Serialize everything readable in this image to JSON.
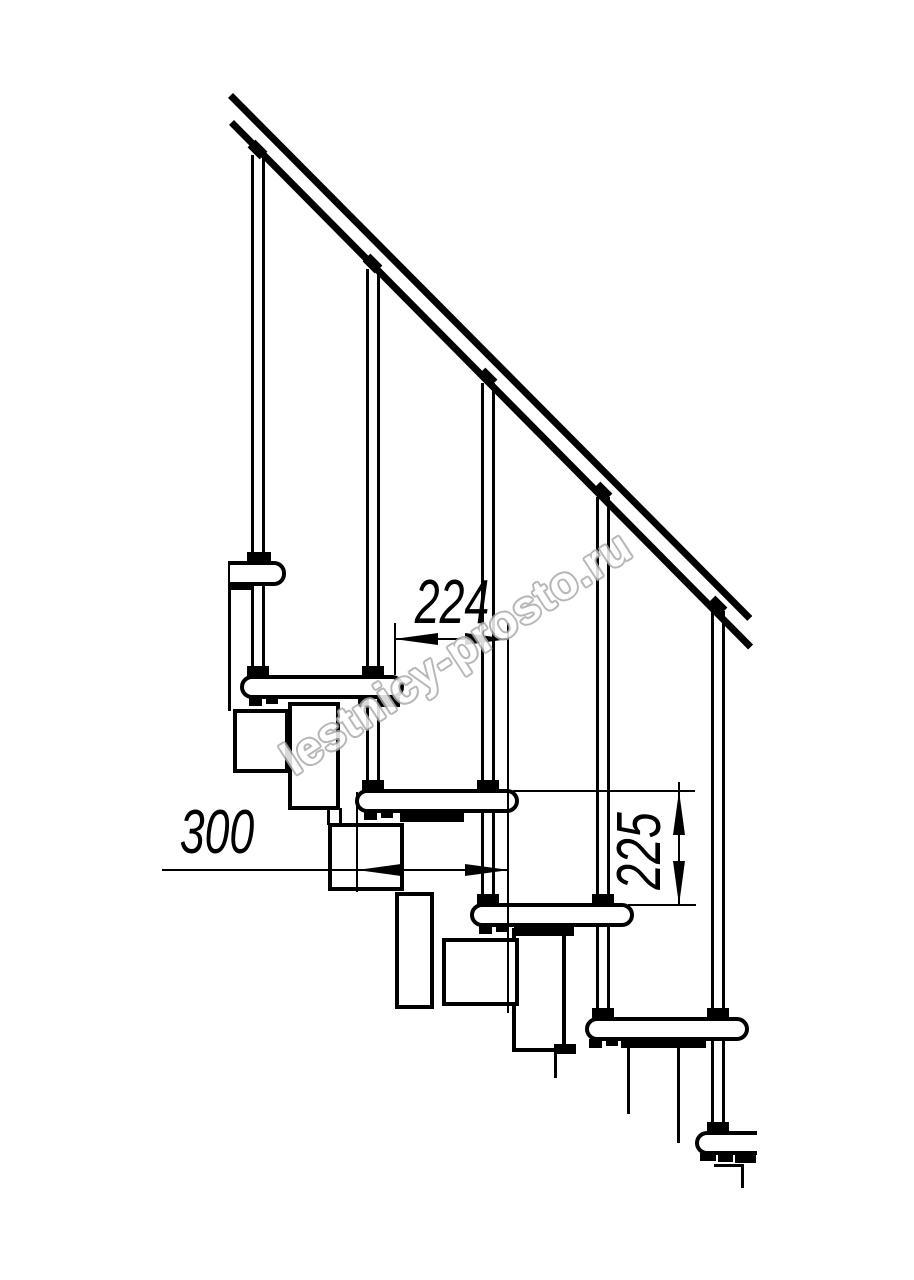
{
  "drawing": {
    "kind": "modular-staircase-side-elevation",
    "colors": {
      "ink": "#000000",
      "background": "#ffffff",
      "watermark_outline": "#ababab"
    },
    "dimensions": {
      "tread_run": "224",
      "tread_depth": "300",
      "riser_height": "225"
    },
    "watermark": {
      "text": "lestnicy-prosto.ru"
    }
  }
}
